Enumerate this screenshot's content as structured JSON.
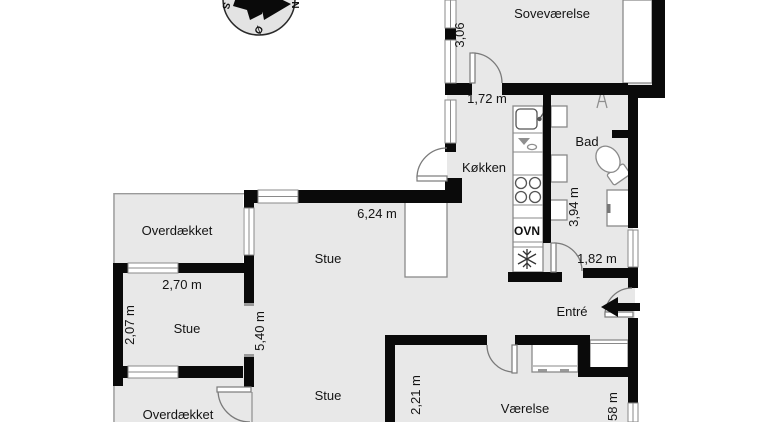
{
  "plan": {
    "type": "floor-plan",
    "language": "danish"
  },
  "rooms": {
    "bedroom": "Soveværelse",
    "kitchen": "Køkken",
    "bath": "Bad",
    "entry": "Entré",
    "living_upper": "Stue",
    "living_lower": "Stue",
    "living_small": "Stue",
    "room": "Værelse",
    "covered_top": "Overdækket",
    "covered_bottom": "Overdækket"
  },
  "appliances": {
    "oven": "OVN"
  },
  "dimensions": {
    "bedroom_width": "3,06",
    "hall_top": "1,72 m",
    "living_top_width": "6,24 m",
    "small_living_width": "2,70 m",
    "small_living_height": "2,07 m",
    "living_left_height": "5,40 m",
    "bath_height": "3,94 m",
    "hall_right": "1,82 m",
    "room_height": "2,21 m",
    "room_right_height": "2,58 m"
  },
  "compass": {
    "north": "N",
    "south": "S",
    "east": "Ø"
  },
  "colors": {
    "room_fill": "#e8e8e8",
    "wall": "#0a0a0a",
    "window_line": "#8a8a8a",
    "background": "#ffffff"
  }
}
